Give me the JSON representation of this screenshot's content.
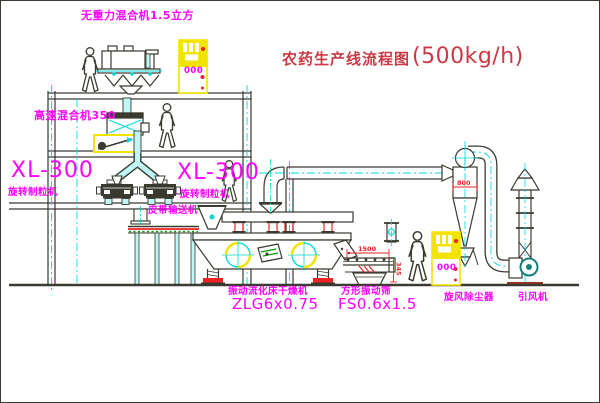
{
  "title": {
    "name_cn": "农药生产线流程图",
    "capacity": "(500kg/h)"
  },
  "equipment_labels": {
    "gravity_mixer": "无重力混合机1.5立方",
    "high_speed_mixer": "高速混合机350",
    "granulator_left": {
      "model": "XL-300",
      "name": "旋转制粒机"
    },
    "granulator_right": {
      "model": "XL-300",
      "name": "旋转制粒机"
    },
    "belt_conveyor": "皮带输送机",
    "fluid_bed_dryer": {
      "name": "振动流化床干燥机",
      "model": "ZLG6x0.75"
    },
    "vibrating_sieve": {
      "name": "方形振动筛",
      "model": "FS0.6x1.5"
    },
    "cyclone": "旋风除尘器",
    "induced_draft_fan": "引风机"
  },
  "dimension_annotations": {
    "sieve_length": "1500",
    "sieve_height": "345",
    "cyclone_body": "800"
  },
  "control_panels": {
    "upper_floor_display": "000",
    "ground_display": "000"
  },
  "colors": {
    "line": "#3a3a30",
    "cyan": "#00d9d9",
    "pipe_fill": "#bff6f6",
    "magenta": "#ff00ff",
    "red": "#ee2222",
    "yellow": "#f2e400",
    "title_red": "#cc3944",
    "green": "#00a000",
    "fan_teal": "#157f7f",
    "base_brown": "#993322",
    "background": "#ffffff"
  }
}
